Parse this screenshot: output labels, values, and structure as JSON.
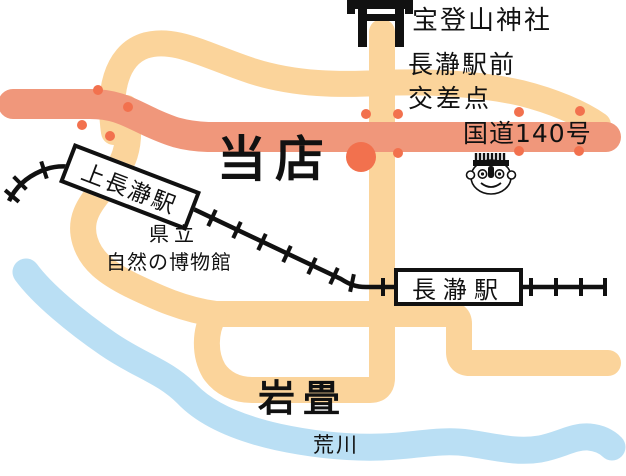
{
  "labels": {
    "shrine": "宝登山神社",
    "crossing_line1": "長瀞駅前",
    "crossing_line2": "交差点",
    "route140": "国道140号",
    "shop": "当店",
    "museum_line1": "県立",
    "museum_line2": "自然の博物館",
    "iwadatami": "岩畳",
    "river": "荒川"
  },
  "stations": {
    "kami_nagatoro": "上長瀞駅",
    "nagatoro": "長瀞駅"
  },
  "icons": {
    "torii": "torii-icon",
    "face": "face-icon",
    "shop_marker": "shop-marker-dot",
    "signal_dots": "signal-dot",
    "railway": "railway-line"
  },
  "colors": {
    "road_minor": "#FBD49B",
    "road_route140": "#F0977B",
    "river": "#BADFF4",
    "marker": "#F2714E",
    "railway": "#111111"
  }
}
